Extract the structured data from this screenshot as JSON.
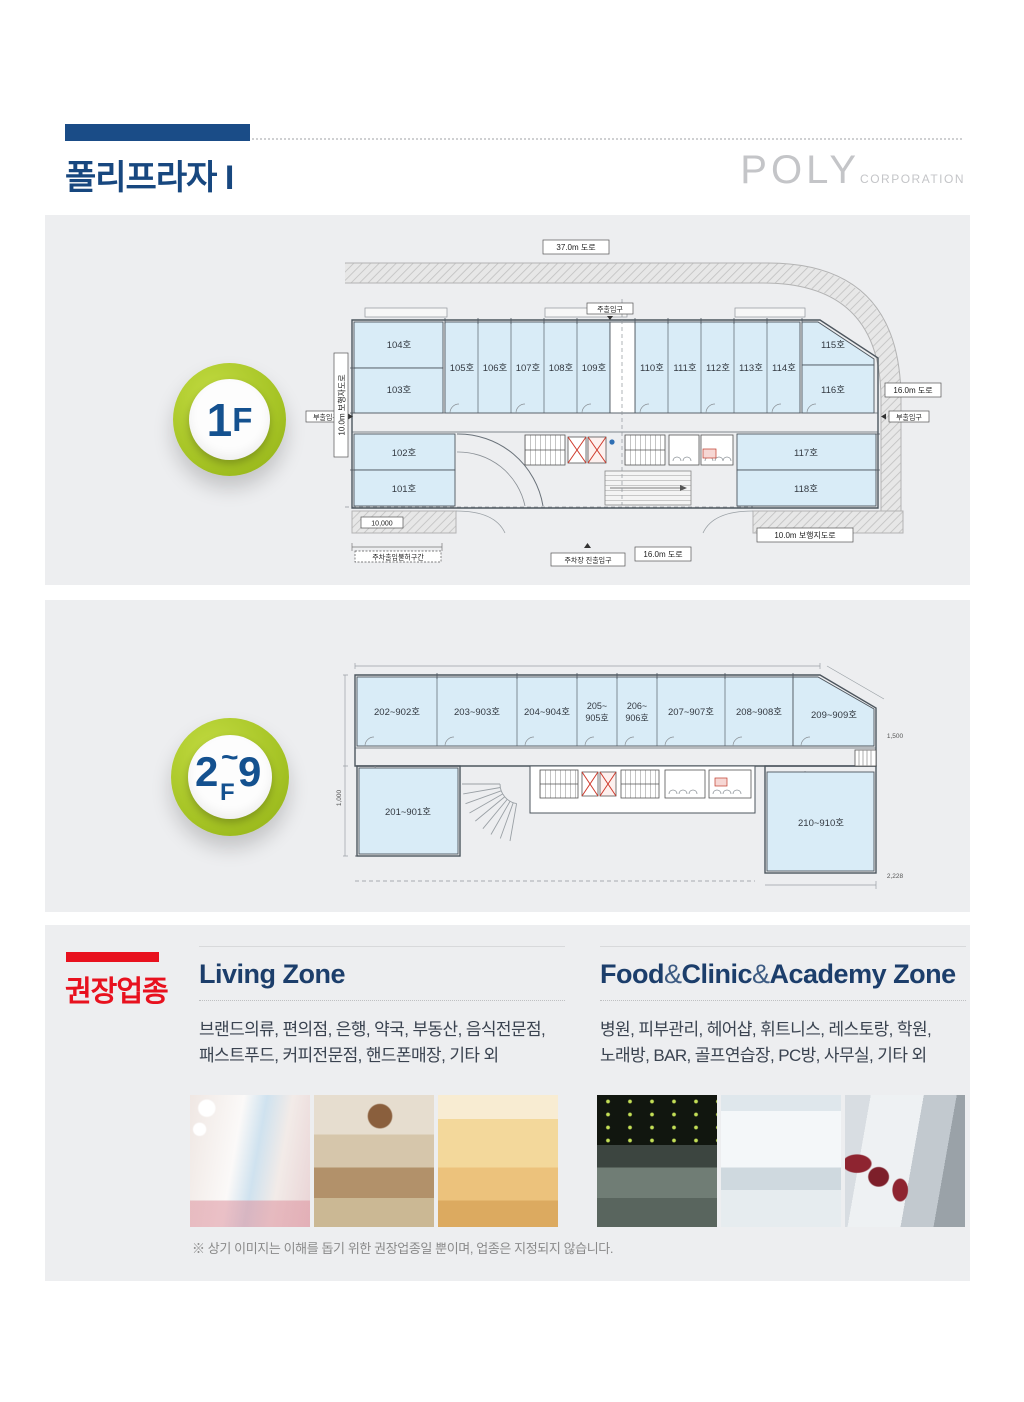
{
  "header": {
    "title": "폴리프라자 I",
    "logo_brand": "POLY",
    "logo_suffix": "CORPORATION",
    "accent_color": "#1a4c87"
  },
  "floor1": {
    "badge_num": "1",
    "badge_f": "F",
    "labels": {
      "road_top": "37.0m 도로",
      "road_right": "16.0m 도로",
      "road_bottom": "16.0m 도로",
      "ped_left": "10.0m 보행자도로",
      "ped_bottom": "10.0m 보행지도로",
      "entrance_main": "주출입구",
      "entrance_side_left": "부출입구",
      "entrance_side_right": "부출입구",
      "parking_gate": "주차장 진출입구",
      "parking_ban": "주차출입불허구간",
      "dim_10000": "10,000"
    },
    "rooms": {
      "r101": "101호",
      "r102": "102호",
      "r103": "103호",
      "r104": "104호",
      "r105": "105호",
      "r106": "106호",
      "r107": "107호",
      "r108": "108호",
      "r109": "109호",
      "r110": "110호",
      "r111": "111호",
      "r112": "112호",
      "r113": "113호",
      "r114": "114호",
      "r115": "115호",
      "r116": "116호",
      "r117": "117호",
      "r118": "118호"
    }
  },
  "floor29": {
    "badge_from": "2",
    "badge_tilde": "~",
    "badge_to": "9",
    "badge_f": "F",
    "rooms_top": [
      {
        "t": "202~902호"
      },
      {
        "t": "203~903호"
      },
      {
        "t": "204~904호"
      },
      {
        "t1": "205~",
        "t2": "905호"
      },
      {
        "t1": "206~",
        "t2": "906호"
      },
      {
        "t": "207~907호"
      },
      {
        "t": "208~908호"
      },
      {
        "t": "209~909호"
      }
    ],
    "room_bottom_left": "201~901호",
    "room_bottom_right": "210~910호",
    "dims": {
      "d1": "1,000",
      "d2": "1,500",
      "d3": "2,228"
    }
  },
  "recommend": {
    "label": "권장업종",
    "red_color": "#e8111e",
    "zones": [
      {
        "title": "Living Zone",
        "desc": [
          "브랜드의류, 편의점, 은행, 약국, 부동산, 음식전문점,",
          "패스트푸드, 커피전문점, 핸드폰매장, 기타 외"
        ],
        "photos": [
          "cosmetics-store",
          "cafe-interior",
          "clothing-store"
        ]
      },
      {
        "title_parts": [
          "Food",
          "&",
          "Clinic",
          "&",
          "Academy Zone"
        ],
        "desc": [
          "병원, 피부관리, 헤어샵, 휘트니스, 레스토랑, 학원,",
          "노래방, BAR, 골프연습장, PC방, 사무실, 기타 외"
        ],
        "photos": [
          "fitness-gym",
          "dental-clinic",
          "pc-room"
        ]
      }
    ],
    "footnote": "※ 상기 이미지는 이해를 돕기 위한 권장업종일 뿐이며, 업종은 지정되지 않습니다."
  }
}
